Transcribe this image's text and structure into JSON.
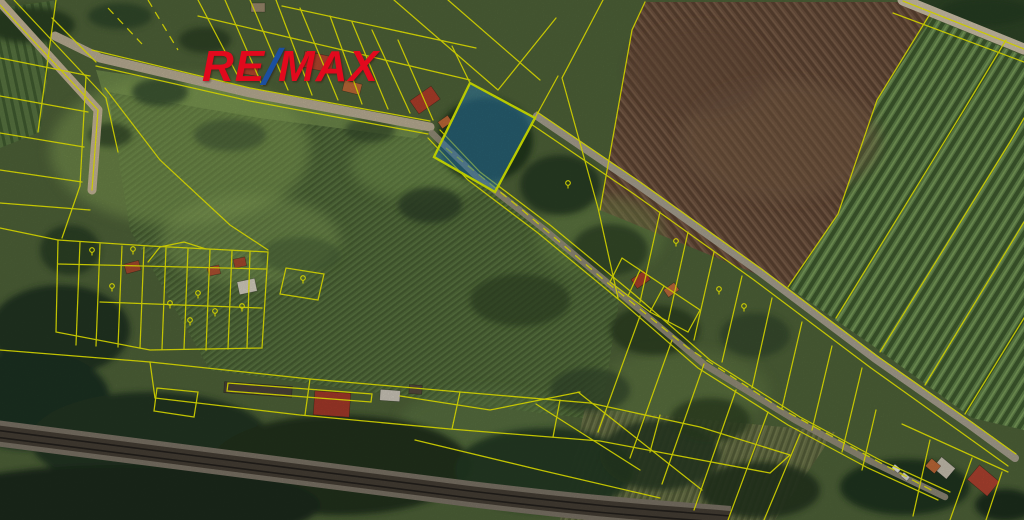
{
  "brand": {
    "re": "RE",
    "slash": "/",
    "max": "MAX",
    "red": "#e2091d",
    "blue": "#1b4fa0"
  },
  "highlight_parcel": {
    "label": "5280/3",
    "label_x": 487,
    "label_y": 133,
    "label_color": "#2f7d52",
    "fill": "#2e86c1",
    "fill_opacity": 0.52,
    "stroke": "#ddf000"
  },
  "style": {
    "boundary_color": "#f2f200",
    "label_color": "#f5f500"
  },
  "parcel_labels": [
    {
      "text": "88/3",
      "x": 313,
      "y": 22
    },
    {
      "text": "5280/22",
      "x": 374,
      "y": 29
    },
    {
      "text": "5280/23",
      "x": 399,
      "y": 48
    },
    {
      "text": "5280/21",
      "x": 413,
      "y": 76
    },
    {
      "text": "5307/1",
      "x": 613,
      "y": 27
    },
    {
      "text": "5480/1",
      "x": 759,
      "y": 71
    },
    {
      "text": "5483",
      "x": 967,
      "y": 25,
      "rot": 21
    },
    {
      "text": "5283",
      "x": 856,
      "y": 178,
      "rot": -58
    },
    {
      "text": "5281/5",
      "x": 920,
      "y": 171
    },
    {
      "text": "5282/1",
      "x": 989,
      "y": 201,
      "rot": -58
    },
    {
      "text": "5281/3",
      "x": 976,
      "y": 393,
      "rot": -58
    },
    {
      "text": "5280/2",
      "x": 570,
      "y": 195
    },
    {
      "text": "5249/2",
      "x": 640,
      "y": 246
    },
    {
      "text": "5280/11",
      "x": 676,
      "y": 254
    },
    {
      "text": "5280/8",
      "x": 704,
      "y": 282
    },
    {
      "text": "5280/14",
      "x": 720,
      "y": 302
    },
    {
      "text": "5287/2",
      "x": 744,
      "y": 319
    },
    {
      "text": "5287/9",
      "x": 754,
      "y": 340,
      "rot": -62
    },
    {
      "text": "5287/3",
      "x": 781,
      "y": 323,
      "rot": -62
    },
    {
      "text": "5287/13",
      "x": 796,
      "y": 344
    },
    {
      "text": "5287/4",
      "x": 840,
      "y": 360
    },
    {
      "text": "5288/4",
      "x": 884,
      "y": 410,
      "rot": -48
    },
    {
      "text": "5307/3",
      "x": 936,
      "y": 447,
      "rot": -48
    },
    {
      "text": "7547/1",
      "x": 110,
      "y": 209
    },
    {
      "text": "7592",
      "x": 367,
      "y": 267
    },
    {
      "text": "278",
      "x": 91,
      "y": 260
    },
    {
      "text": "279",
      "x": 133,
      "y": 259
    },
    {
      "text": "87/1",
      "x": 167,
      "y": 281
    },
    {
      "text": "7821",
      "x": 70,
      "y": 301
    },
    {
      "text": "7822",
      "x": 110,
      "y": 296
    },
    {
      "text": "7823",
      "x": 142,
      "y": 297
    },
    {
      "text": "7824",
      "x": 170,
      "y": 313
    },
    {
      "text": "7825",
      "x": 190,
      "y": 330
    },
    {
      "text": "7826",
      "x": 198,
      "y": 303
    },
    {
      "text": "7827",
      "x": 241,
      "y": 316
    },
    {
      "text": "7828",
      "x": 215,
      "y": 321
    },
    {
      "text": "7832",
      "x": 117,
      "y": 346
    },
    {
      "text": "5302",
      "x": 308,
      "y": 362
    },
    {
      "text": "5295/3",
      "x": 284,
      "y": 382
    },
    {
      "text": "5296",
      "x": 240,
      "y": 405
    },
    {
      "text": "84/13",
      "x": 337,
      "y": 393
    },
    {
      "text": "102",
      "x": 177,
      "y": 403,
      "rot": -28
    },
    {
      "text": "5298",
      "x": 447,
      "y": 423
    },
    {
      "text": "5307",
      "x": 570,
      "y": 430
    },
    {
      "text": "5294",
      "x": 716,
      "y": 497
    }
  ],
  "symbols": [
    {
      "type": "vineyard-icon",
      "glyph": "$",
      "x": 757,
      "y": 58
    },
    {
      "type": "vineyard-icon",
      "glyph": "$",
      "x": 862,
      "y": 158
    },
    {
      "type": "vineyard-icon",
      "glyph": "$",
      "x": 918,
      "y": 159
    },
    {
      "type": "vineyard-icon",
      "glyph": "$",
      "x": 997,
      "y": 179
    },
    {
      "type": "vineyard-icon",
      "glyph": "$",
      "x": 637,
      "y": 234
    },
    {
      "type": "vineyard-icon",
      "glyph": "$",
      "x": 761,
      "y": 328
    },
    {
      "type": "vineyard-icon",
      "glyph": "$",
      "x": 789,
      "y": 314
    },
    {
      "type": "vineyard-icon",
      "glyph": "$",
      "x": 797,
      "y": 334
    },
    {
      "type": "vineyard-icon",
      "glyph": "$",
      "x": 838,
      "y": 351
    },
    {
      "type": "vineyard-icon",
      "glyph": "$",
      "x": 886,
      "y": 398
    },
    {
      "type": "vineyard-icon",
      "glyph": "$",
      "x": 931,
      "y": 433
    },
    {
      "type": "vineyard-icon",
      "glyph": "$",
      "x": 977,
      "y": 466
    },
    {
      "type": "tree-icon",
      "x": 568,
      "y": 185
    },
    {
      "type": "tree-icon",
      "x": 676,
      "y": 243
    },
    {
      "type": "tree-icon",
      "x": 719,
      "y": 291
    },
    {
      "type": "tree-icon",
      "x": 744,
      "y": 308
    },
    {
      "type": "tree-icon",
      "x": 92,
      "y": 252
    },
    {
      "type": "tree-icon",
      "x": 133,
      "y": 251
    },
    {
      "type": "tree-icon",
      "x": 112,
      "y": 288
    },
    {
      "type": "tree-icon",
      "x": 170,
      "y": 305
    },
    {
      "type": "tree-icon",
      "x": 198,
      "y": 295
    },
    {
      "type": "tree-icon",
      "x": 215,
      "y": 313
    },
    {
      "type": "tree-icon",
      "x": 242,
      "y": 308
    },
    {
      "type": "tree-icon",
      "x": 190,
      "y": 322
    },
    {
      "type": "tree-icon",
      "x": 303,
      "y": 280
    },
    {
      "type": "area-letter-icon",
      "glyph": "Q",
      "x": 701,
      "y": 271
    },
    {
      "type": "area-letter-icon",
      "glyph": "Q",
      "x": 142,
      "y": 289
    },
    {
      "type": "area-letter-icon",
      "glyph": "Q",
      "x": 70,
      "y": 293
    },
    {
      "type": "area-letter-icon",
      "glyph": "a",
      "x": 957,
      "y": 442
    },
    {
      "type": "meadow-icon",
      "glyph": "II",
      "x": 571,
      "y": 423
    }
  ]
}
